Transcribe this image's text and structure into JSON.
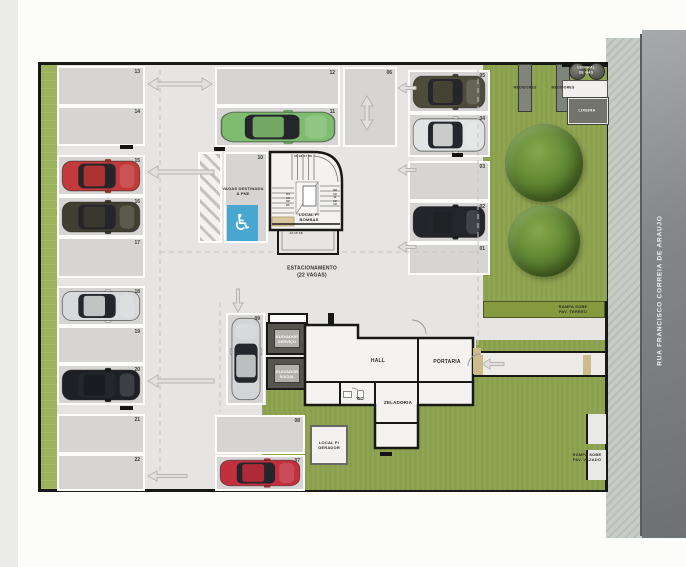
{
  "street": {
    "name": "RUA FRANCISCO CORREIA DE ARAUJO"
  },
  "labels": {
    "estacionamento": "ESTACIONAMENTO\n(22 VAGAS)",
    "vagas_pne": "VAGAS DESTINADA\nA PNE",
    "local_bombas": "LOCAL P/\nBOMBAS",
    "hall": "HALL",
    "portaria": "PORTARIA",
    "zeladoria": "ZELADORIA",
    "wc": "WC",
    "gerador": "LOCAL P/\nGERADOR",
    "elevador_servico": "ELEVADOR\nSERVIÇO",
    "elevador_social": "ELEVADOR\nSOCIAL",
    "medidores_1": "MEDIDORES",
    "medidores_2": "MEDIDORES",
    "central_gas": "CENTRAL\nDE GÁS",
    "lixeira": "LIXEIRA",
    "rampa_terreo": "RAMPA SOBE\nPAV. TERREO",
    "rampa_vazado": "RAMPA SOBE\nPAV. VAZADO",
    "stair_steps_top": "05 06 07 08",
    "stair_steps_left": "04\n03\n02\n01",
    "stair_steps_right": "09\n10\n11\n12\n13",
    "stair_steps_bottom": "14 15 16"
  },
  "icons": {
    "accessible": "♿"
  },
  "colors": {
    "pne_blue": "#49a7cf",
    "grass": "#8ba04c",
    "hedge": "#9db25c",
    "pavement": "#e6e5e3",
    "space_fill": "#d6d5d3",
    "road": "#7d8082"
  },
  "spaces": [
    {
      "id": "13",
      "x": 57,
      "y": 66,
      "w": 88,
      "h": 40,
      "car": null
    },
    {
      "id": "14",
      "x": 57,
      "y": 106,
      "w": 88,
      "h": 40,
      "car": null
    },
    {
      "id": "15",
      "x": 57,
      "y": 155,
      "w": 88,
      "h": 41,
      "car": {
        "color": "#c23a3a",
        "dir": "right"
      }
    },
    {
      "id": "16",
      "x": 57,
      "y": 196,
      "w": 88,
      "h": 41,
      "car": {
        "color": "#403f31",
        "dir": "right"
      }
    },
    {
      "id": "17",
      "x": 57,
      "y": 237,
      "w": 88,
      "h": 41,
      "car": null
    },
    {
      "id": "18",
      "x": 57,
      "y": 286,
      "w": 88,
      "h": 40,
      "car": {
        "color": "#d7d9db",
        "dir": "right"
      }
    },
    {
      "id": "19",
      "x": 57,
      "y": 326,
      "w": 88,
      "h": 38,
      "car": null
    },
    {
      "id": "20",
      "x": 57,
      "y": 364,
      "w": 88,
      "h": 41,
      "car": {
        "color": "#1e2025",
        "dir": "right"
      }
    },
    {
      "id": "21",
      "x": 57,
      "y": 414,
      "w": 88,
      "h": 40,
      "car": null
    },
    {
      "id": "22",
      "x": 57,
      "y": 454,
      "w": 88,
      "h": 37,
      "car": null
    },
    {
      "id": "12",
      "x": 215,
      "y": 67,
      "w": 125,
      "h": 39,
      "car": null
    },
    {
      "id": "11",
      "x": 215,
      "y": 106,
      "w": 125,
      "h": 41,
      "car": {
        "color": "#7fbc70",
        "dir": "right"
      }
    },
    {
      "id": "06",
      "x": 343,
      "y": 67,
      "w": 54,
      "h": 80,
      "car": null
    },
    {
      "id": "10",
      "x": 224,
      "y": 152,
      "w": 44,
      "h": 91,
      "car": null,
      "pne": true
    },
    {
      "id": "09",
      "x": 226,
      "y": 313,
      "w": 39,
      "h": 92,
      "car": {
        "color": "#d2d4d6",
        "dir": "up"
      }
    },
    {
      "id": "08",
      "x": 215,
      "y": 415,
      "w": 90,
      "h": 39,
      "car": null
    },
    {
      "id": "07",
      "x": 215,
      "y": 455,
      "w": 90,
      "h": 36,
      "car": {
        "color": "#c22f3d",
        "dir": "right"
      }
    },
    {
      "id": "05",
      "x": 408,
      "y": 70,
      "w": 82,
      "h": 43,
      "car": {
        "color": "#4d4c3a",
        "dir": "right"
      }
    },
    {
      "id": "04",
      "x": 408,
      "y": 113,
      "w": 82,
      "h": 44,
      "car": {
        "color": "#e2e3e4",
        "dir": "right"
      }
    },
    {
      "id": "03",
      "x": 408,
      "y": 161,
      "w": 82,
      "h": 40,
      "car": null
    },
    {
      "id": "02",
      "x": 408,
      "y": 201,
      "w": 82,
      "h": 42,
      "car": {
        "color": "#23252a",
        "dir": "right"
      }
    },
    {
      "id": "01",
      "x": 408,
      "y": 243,
      "w": 82,
      "h": 32,
      "car": null
    }
  ]
}
